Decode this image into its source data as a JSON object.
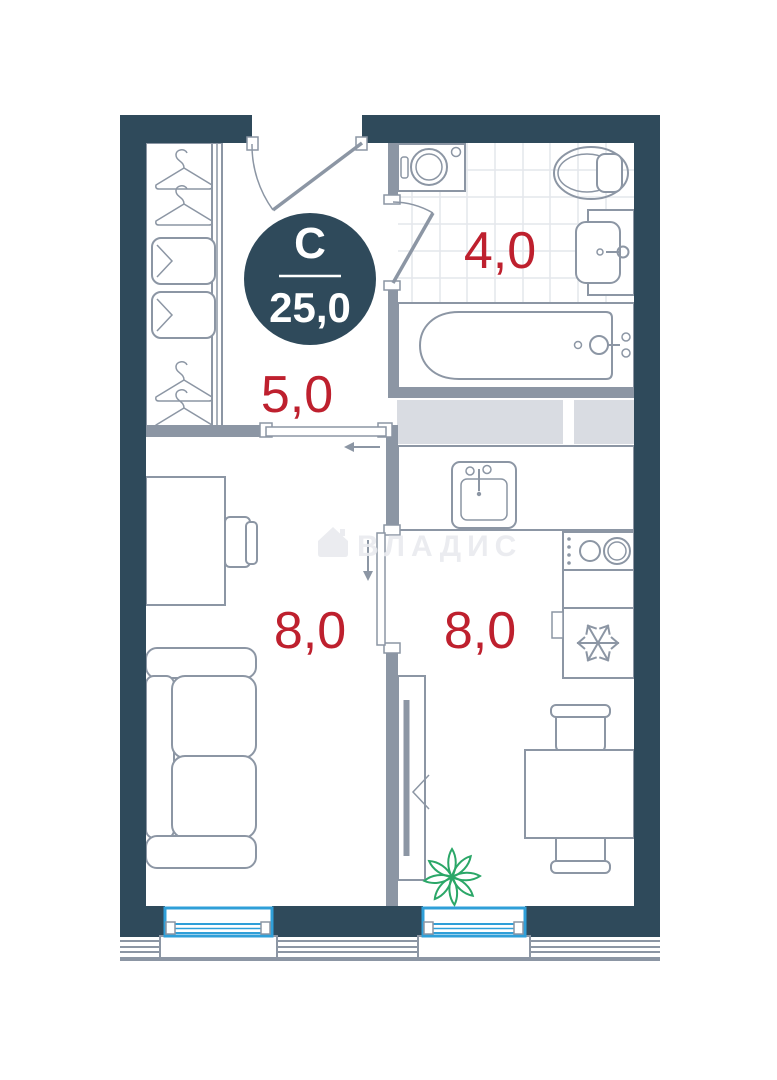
{
  "plan": {
    "badge": {
      "room_type": "С",
      "total_area": "25,0"
    },
    "rooms": {
      "hallway": {
        "area": "5,0"
      },
      "bathroom": {
        "area": "4,0"
      },
      "living_room": {
        "area": "8,0"
      },
      "kitchen": {
        "area": "8,0"
      }
    },
    "watermark": {
      "text": "ВЛАДИС"
    }
  },
  "colors": {
    "wall": "#2f4a5b",
    "inner_wall": "#8c96a4",
    "line": "#8c96a4",
    "accent_red": "#be202e",
    "window_blue": "#2f9fd8",
    "plant_green": "#2ba768",
    "cabinet_gray": "#d9dce2",
    "tile": "#e4e7ec",
    "watermark_color": "#e9ebef",
    "badge_bg": "#2f4a5b"
  }
}
